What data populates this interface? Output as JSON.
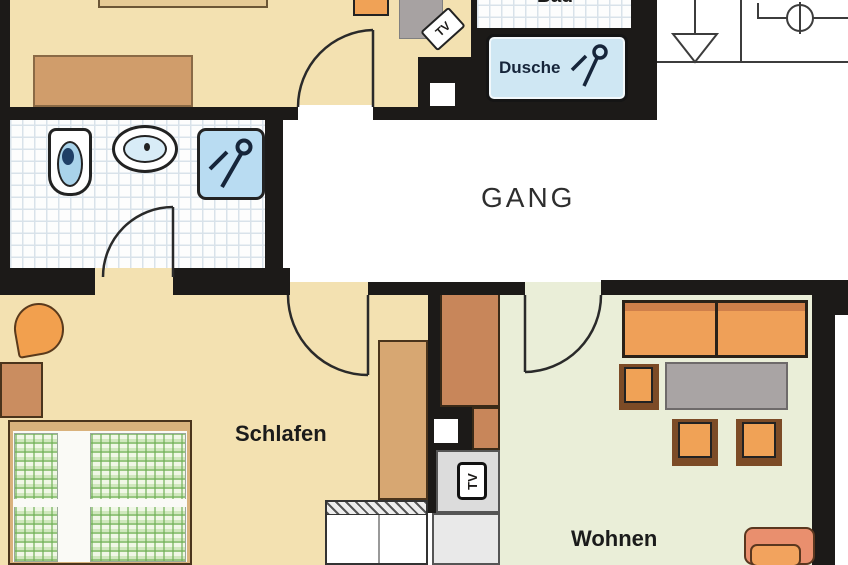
{
  "plan": {
    "type": "apartment-floor-plan",
    "rooms": {
      "corridor": {
        "label": "GANG"
      },
      "bedroom": {
        "label": "Schlafen"
      },
      "living": {
        "label": "Wohnen"
      },
      "bath": {
        "label": "Bad"
      },
      "shower_cabin": {
        "label": "Dusche"
      }
    },
    "labels": {
      "tv_top_room": "TV",
      "tv_living": "TV"
    },
    "colors": {
      "wall": "#1c1a18",
      "floor_beige": "#f3e1b1",
      "floor_green": "#eaeed8",
      "tile_floor": "#fdfdfd",
      "shower_blue": "#cfe7f3",
      "fixture_blue": "#a9d3ea",
      "furniture_orange": "#f0a256",
      "furniture_brown": "#c8865a",
      "furniture_tan": "#d7a772",
      "sofa_orange": "#efa058",
      "chair_salmon": "#e98f6e",
      "table_gray": "#a9a4a4",
      "duvet_green": "#8cc47e"
    }
  }
}
